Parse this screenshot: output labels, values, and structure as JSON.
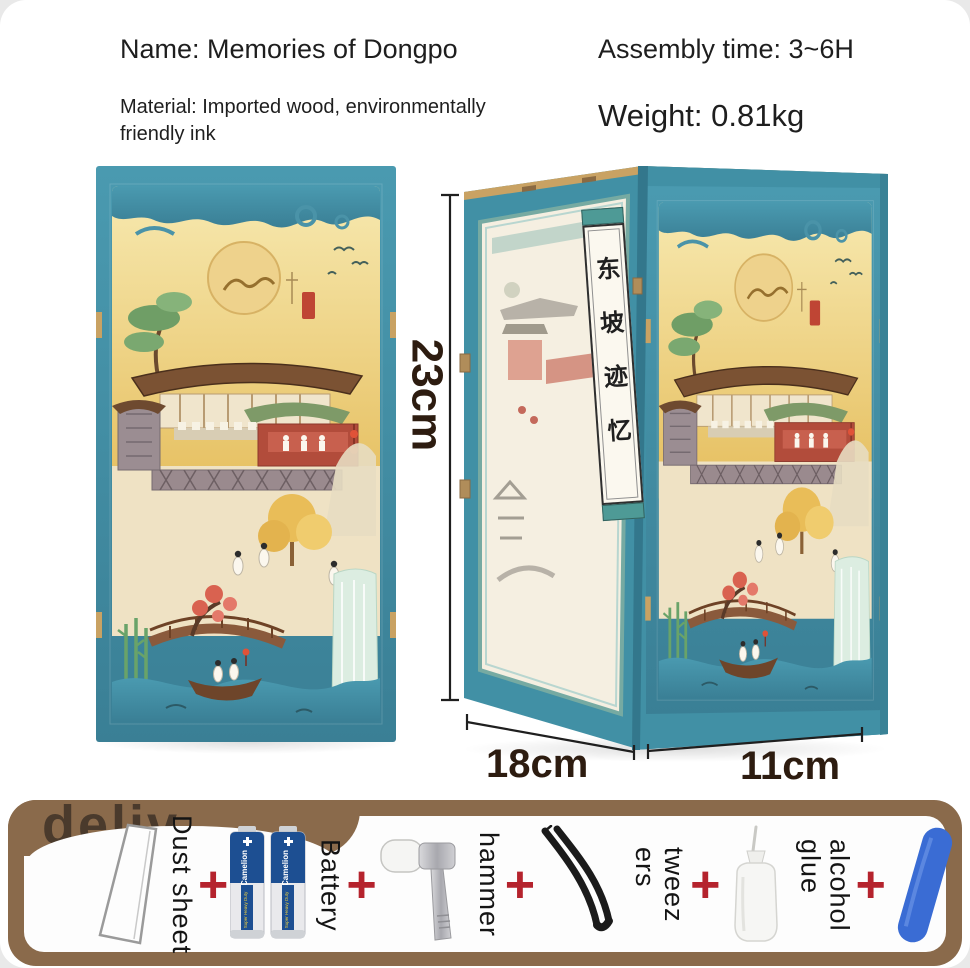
{
  "header": {
    "name": "Name: Memories of Dongpo",
    "assembly_time": "Assembly time: 3~6H",
    "material": "Material: Imported wood, environmentally\nfriendly ink",
    "weight": "Weight: 0.81kg"
  },
  "dimensions": {
    "height": "23cm",
    "width": "18cm",
    "depth": "11cm"
  },
  "product": {
    "scroll_title": "东坡迹忆"
  },
  "accessories_bar": {
    "watermark": "deliv",
    "plus": "+",
    "items": [
      {
        "label": "Dust sheet"
      },
      {
        "label": "Battery",
        "brand": "Camelion",
        "brand_sub": "Super Heavy Duty"
      },
      {
        "label": "hammer"
      },
      {
        "label": "tweez\ners"
      },
      {
        "label": "alcohol\nglue"
      },
      {
        "label": "scrub stick"
      }
    ]
  },
  "colors": {
    "frame_teal": "#4190a5",
    "sky_gold": "#ecc968",
    "wood_tan": "#c9a263",
    "bar_brown": "#8a6a4b",
    "plus_red": "#b5232d",
    "battery_blue": "#1d4f92",
    "scrub_blue": "#3a6cd4"
  }
}
